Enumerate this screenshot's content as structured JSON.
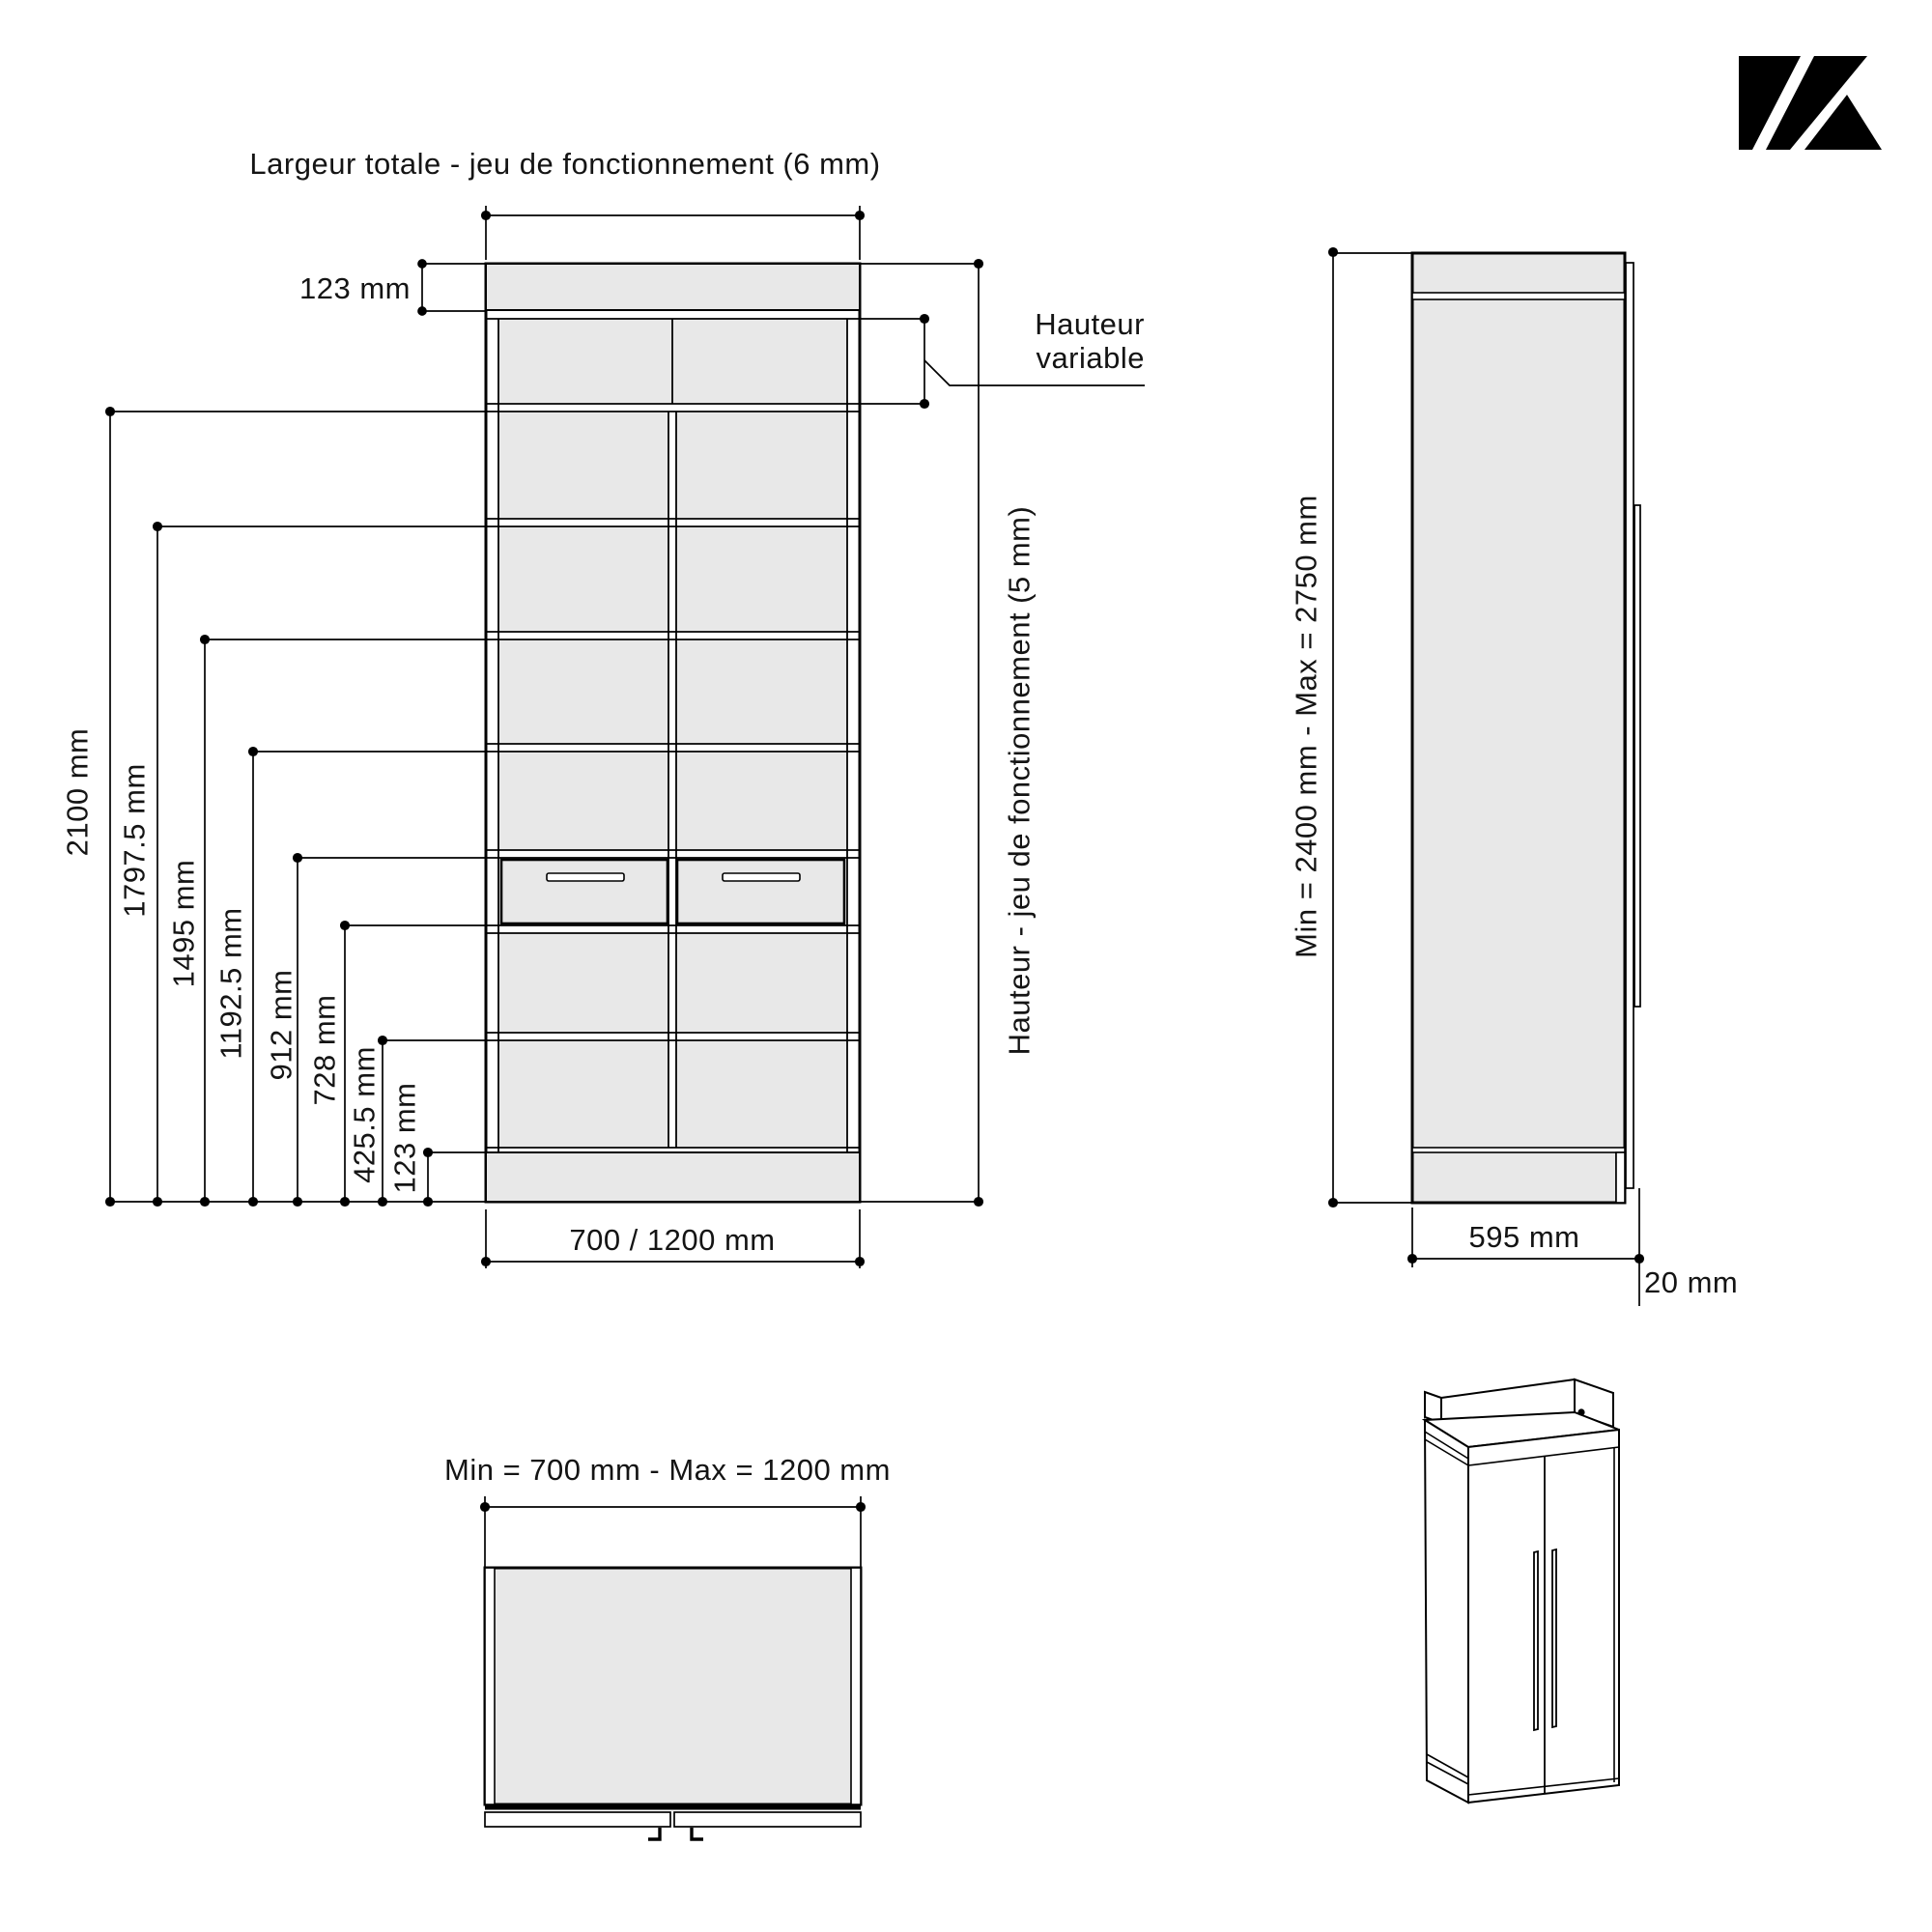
{
  "brand": {
    "logo_name": "K-mark logo"
  },
  "front_view": {
    "title": "Largeur totale - jeu de fonctionnement (6 mm)",
    "top_panel_dim": "123 mm",
    "variable_height_line1": "Hauteur",
    "variable_height_line2": "variable",
    "right_height_label": "Hauteur - jeu de fonctionnement (5 mm)",
    "bottom_width_label": "700 / 1200 mm",
    "height_labels": [
      {
        "text": "2100 mm"
      },
      {
        "text": "1797.5 mm"
      },
      {
        "text": "1495 mm"
      },
      {
        "text": "1192.5 mm"
      },
      {
        "text": "912 mm"
      },
      {
        "text": "728 mm"
      },
      {
        "text": "425.5 mm"
      },
      {
        "text": "123 mm"
      }
    ]
  },
  "side_view": {
    "height_label": "Min = 2400 mm - Max = 2750 mm",
    "depth_label": "595 mm",
    "door_thickness_label": "20 mm"
  },
  "top_view": {
    "width_label": "Min = 700 mm - Max = 1200 mm"
  }
}
